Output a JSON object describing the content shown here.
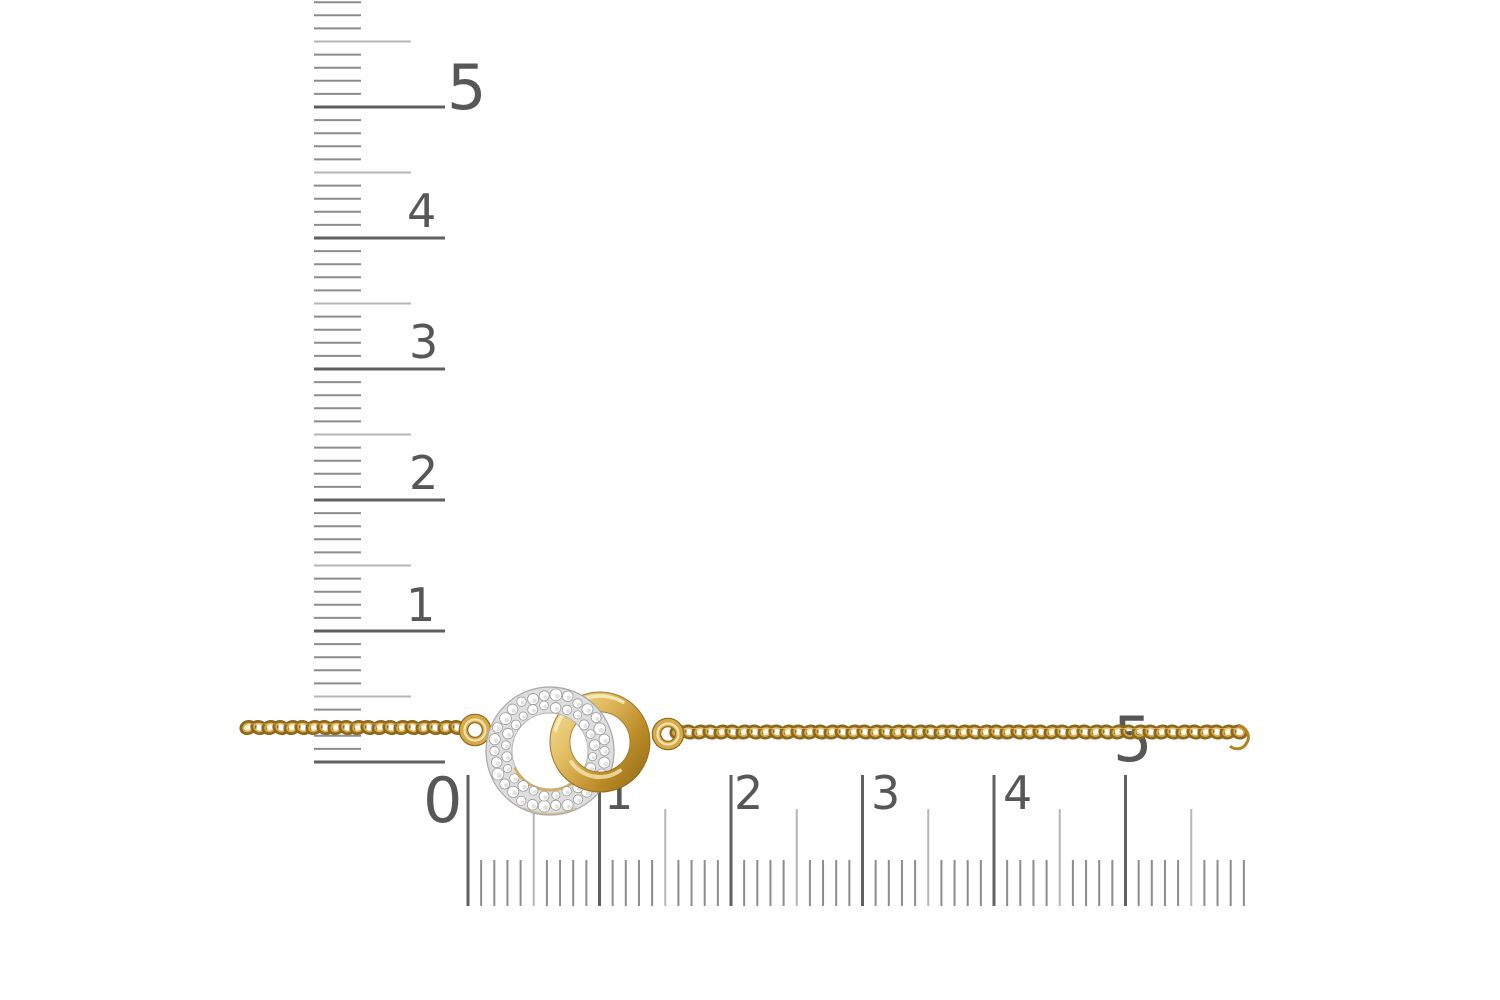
{
  "photo": {
    "background": "#ffffff",
    "alt": "gold chain with interlocking pave-diamond circle and polished gold circle charm, measured by vertical and horizontal rulers"
  },
  "rulers": {
    "vertical": {
      "tick_x": 314,
      "zero_y": 762,
      "px_per_mm": 13.1,
      "mm_count": 59,
      "len": {
        "minor": 47,
        "half": 97,
        "major": 131
      },
      "labels": [
        {
          "text": "5",
          "x": 447,
          "baseline": 109,
          "size": 62
        },
        {
          "text": "4",
          "x": 407,
          "baseline": 227,
          "size": 46
        },
        {
          "text": "3",
          "x": 409,
          "baseline": 358,
          "size": 46
        },
        {
          "text": "2",
          "x": 409,
          "baseline": 489,
          "size": 46
        },
        {
          "text": "1",
          "x": 406,
          "baseline": 621,
          "size": 46
        }
      ]
    },
    "horizontal": {
      "zero_x": 468,
      "bottom_y": 906,
      "px_per_mm": 13.15,
      "mm_count": 60,
      "len": {
        "minor": 46,
        "half": 97,
        "major": 131
      },
      "labels": [
        {
          "text": "0",
          "x": 423,
          "baseline": 822,
          "size": 62
        },
        {
          "text": "1",
          "x": 604,
          "baseline": 809,
          "size": 46
        },
        {
          "text": "2",
          "x": 734,
          "baseline": 809,
          "size": 46
        },
        {
          "text": "3",
          "x": 871,
          "baseline": 809,
          "size": 46
        },
        {
          "text": "4",
          "x": 1003,
          "baseline": 809,
          "size": 46
        },
        {
          "text": "5",
          "x": 1113,
          "baseline": 761,
          "size": 62
        }
      ]
    }
  },
  "chain": {
    "link_pitch": 11,
    "segments": [
      {
        "x1": 248,
        "x2": 466,
        "y": 727.5
      },
      {
        "x1": 678,
        "x2": 1240,
        "y": 732
      }
    ],
    "end_curl": {
      "x": 1238,
      "y": 728
    }
  },
  "pendant": {
    "jump_rings": [
      {
        "cx": 475,
        "cy": 730,
        "r": 11.5
      },
      {
        "cx": 668,
        "cy": 734,
        "r": 11.5
      }
    ],
    "gold_ring": {
      "cx": 600,
      "cy": 742,
      "r_outer": 50,
      "r_inner": 30
    },
    "diamond_ring": {
      "cx": 550,
      "cy": 751,
      "r_outer": 64,
      "r_inner": 38,
      "stone_rows": [
        {
          "r": 56,
          "count": 30,
          "stone_r": 5.3
        },
        {
          "r": 44.5,
          "count": 24,
          "stone_r": 4.7
        }
      ]
    },
    "overlap_clip": {
      "x": 556,
      "y": 764,
      "w": 84,
      "h": 44
    }
  },
  "palette": {
    "ruler_major": "#5f5f5f",
    "ruler_half": "#b5b5b5",
    "ruler_minor": "#8c8c8c",
    "ruler_label": "#575757",
    "gold_light": "#f7e9b8",
    "gold_mid": "#d6a94a",
    "gold_deep": "#b3831f",
    "gold_dark": "#8d671a",
    "gold_grad": [
      "#f4e2a0",
      "#e2bd62",
      "#bd8c28",
      "#9c731c"
    ],
    "pave_base": "#dedede",
    "pave_edge": "#a6a6a6",
    "stone_white": "#ffffff",
    "stone_edge": "#9c9c9c"
  }
}
